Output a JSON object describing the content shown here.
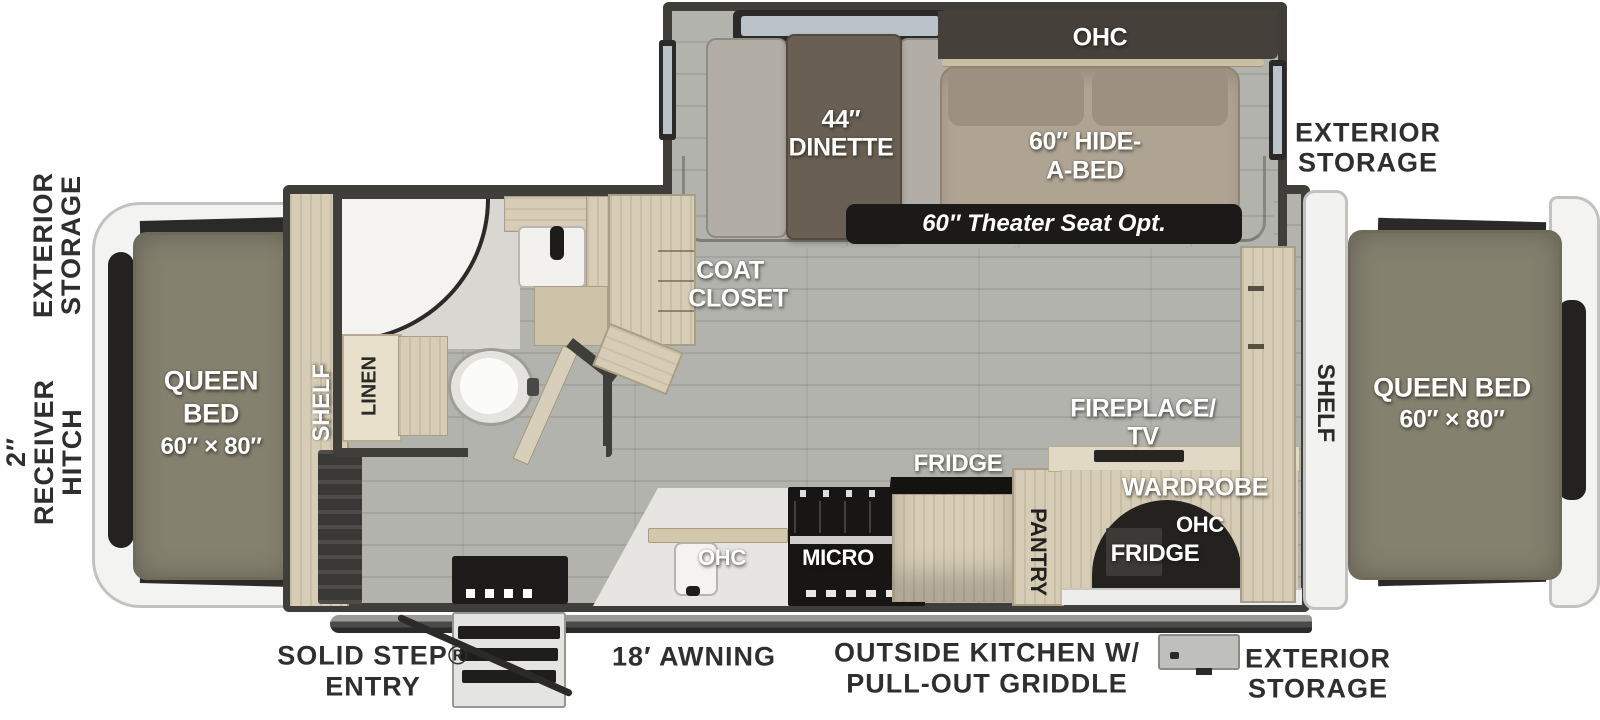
{
  "palette": {
    "wall": "#3F3E3B",
    "floor": "#B3B3AD",
    "wood": "#D7CDB6",
    "wood-dark": "#CDC3A9",
    "wood-edge": "#A89E84",
    "mattress": "#85816F",
    "mattress-edge": "#6F6B5B",
    "bench": "#B2AEA5",
    "table-brown": "#6A5F53",
    "sofa": "#AFA492",
    "sofa-back": "#9C9180",
    "ohc-band": "#45403A",
    "window-glass": "#B9C3C9",
    "frame-dark": "#2B2A28",
    "cap-white": "#F3F3F1",
    "cap-edge": "#C2C2BE",
    "dark": "#23221F",
    "badge": "#1B1A18",
    "counter": "#E6E5E1",
    "label-dark": "#2F2F2F",
    "steel-dark": "#1D1C1B"
  },
  "exterior": {
    "front_storage_l1": "EXTERIOR",
    "front_storage_l2": "STORAGE",
    "hitch_l1": "2″",
    "hitch_l2": "RECEIVER",
    "hitch_l3": "HITCH",
    "top_right_storage_l1": "EXTERIOR",
    "top_right_storage_l2": "STORAGE",
    "bottom_right_storage_l1": "EXTERIOR",
    "bottom_right_storage_l2": "STORAGE",
    "solid_step_l1": "SOLID STEP®",
    "solid_step_l2": "ENTRY",
    "awning": "18′ AWNING",
    "outside_kitchen_l1": "OUTSIDE KITCHEN W/",
    "outside_kitchen_l2": "PULL-OUT GRIDDLE"
  },
  "front_bed": {
    "l1": "QUEEN",
    "l2": "BED",
    "l3": "60″ × 80″",
    "shelf": "SHELF"
  },
  "bathroom": {
    "linen": "LINEN"
  },
  "living": {
    "ohc": "OHC",
    "dinette_l1": "44″",
    "dinette_l2": "DINETTE",
    "hide_a_bed_l1": "60″ HIDE-",
    "hide_a_bed_l2": "A-BED",
    "theater_seat": "60″ Theater Seat Opt.",
    "coat_closet_l1": "COAT",
    "coat_closet_l2": "CLOSET"
  },
  "kitchen": {
    "ohc": "OHC",
    "micro": "MICRO",
    "fridge": "FRIDGE",
    "pantry": "PANTRY"
  },
  "rear": {
    "fireplace_l1": "FIREPLACE/",
    "fireplace_l2": "TV",
    "wardrobe": "WARDROBE",
    "ohc": "OHC",
    "fridge": "FRIDGE",
    "shelf": "SHELF",
    "bed_l1": "QUEEN BED",
    "bed_l2": "60″ × 80″"
  }
}
